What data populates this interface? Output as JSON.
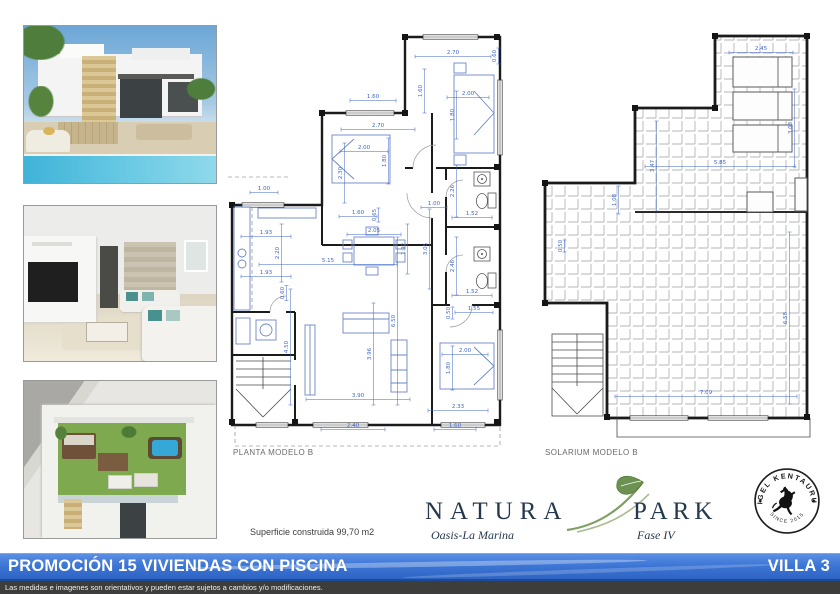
{
  "colors": {
    "bar_blue": "#3d76d6",
    "dimension_blue": "#3f66c8",
    "brand_navy": "#24384e",
    "leaf_green": "#6d9150",
    "pool_blue": "#45b4d8"
  },
  "photos": [
    {
      "name": "villa-exterior-render"
    },
    {
      "name": "living-room-interior-render"
    },
    {
      "name": "rooftop-solarium-render"
    }
  ],
  "plans": {
    "planta": {
      "label": "PLANTA MODELO B",
      "dims": [
        {
          "t": "2.70",
          "x": 225,
          "y": 29,
          "len": 76
        },
        {
          "t": "0.60",
          "x": 268,
          "y": 31,
          "r": -90,
          "len": 16
        },
        {
          "t": "1.60",
          "x": 194,
          "y": 66,
          "r": -90,
          "len": 44
        },
        {
          "t": "2.00",
          "x": 240,
          "y": 70,
          "len": 42
        },
        {
          "t": "1.80",
          "x": 226,
          "y": 90,
          "r": -90,
          "len": 48
        },
        {
          "t": "1.60",
          "x": 145,
          "y": 73,
          "len": 46
        },
        {
          "t": "2.70",
          "x": 150,
          "y": 102,
          "len": 74
        },
        {
          "t": "2.00",
          "x": 136,
          "y": 124,
          "len": 48
        },
        {
          "t": "1.80",
          "x": 158,
          "y": 136,
          "r": -90,
          "len": 46
        },
        {
          "t": "2.30",
          "x": 114,
          "y": 148,
          "r": -90,
          "len": 60
        },
        {
          "t": "1.00",
          "x": 206,
          "y": 180,
          "len": 26
        },
        {
          "t": "1.60",
          "x": 130,
          "y": 189,
          "len": 38
        },
        {
          "t": "0.65",
          "x": 148,
          "y": 190,
          "r": -90,
          "len": 14
        },
        {
          "t": "2.26",
          "x": 226,
          "y": 166,
          "r": -90,
          "len": 52
        },
        {
          "t": "1.52",
          "x": 244,
          "y": 190,
          "len": 40
        },
        {
          "t": "3.05",
          "x": 199,
          "y": 224,
          "r": -90,
          "len": 80
        },
        {
          "t": "2.46",
          "x": 226,
          "y": 241,
          "r": -90,
          "len": 58
        },
        {
          "t": "1.52",
          "x": 244,
          "y": 268,
          "len": 40
        },
        {
          "t": "0.50",
          "x": 222,
          "y": 288,
          "r": -90,
          "len": 12
        },
        {
          "t": "1.55",
          "x": 246,
          "y": 285,
          "len": 38
        },
        {
          "t": "1.00",
          "x": 36,
          "y": 165,
          "len": 28
        },
        {
          "t": "1.93",
          "x": 38,
          "y": 209,
          "len": 50
        },
        {
          "t": "2.20",
          "x": 51,
          "y": 228,
          "r": -90,
          "len": 58
        },
        {
          "t": "1.93",
          "x": 38,
          "y": 249,
          "len": 50
        },
        {
          "t": "0.60",
          "x": 56,
          "y": 268,
          "r": -90,
          "len": 15
        },
        {
          "t": "2.05",
          "x": 146,
          "y": 207,
          "len": 54
        },
        {
          "t": "5.15",
          "x": 100,
          "y": 237,
          "len": 138
        },
        {
          "t": "1.92",
          "x": 177,
          "y": 224,
          "r": -90,
          "len": 50
        },
        {
          "t": "4.50",
          "x": 60,
          "y": 322,
          "r": -90,
          "len": 116
        },
        {
          "t": "3.96",
          "x": 143,
          "y": 329,
          "r": -90,
          "len": 102
        },
        {
          "t": "6.50",
          "x": 167,
          "y": 296,
          "r": -90,
          "len": 168
        },
        {
          "t": "3.90",
          "x": 130,
          "y": 372,
          "len": 104
        },
        {
          "t": "2.40",
          "x": 125,
          "y": 402,
          "len": 64
        },
        {
          "t": "1.60",
          "x": 227,
          "y": 402,
          "len": 42
        },
        {
          "t": "2.33",
          "x": 230,
          "y": 383,
          "len": 60
        },
        {
          "t": "2.00",
          "x": 237,
          "y": 327,
          "len": 46
        },
        {
          "t": "1.80",
          "x": 222,
          "y": 343,
          "r": -90,
          "len": 44
        }
      ]
    },
    "solarium": {
      "label": "SOLARIUM MODELO B",
      "dims": [
        {
          "t": "2.45",
          "x": 221,
          "y": 22,
          "len": 64
        },
        {
          "t": "3.03",
          "x": 252,
          "y": 100,
          "r": -90,
          "len": 78
        },
        {
          "t": "5.85",
          "x": 180,
          "y": 136,
          "len": 150
        },
        {
          "t": "3.47",
          "x": 114,
          "y": 138,
          "r": -90,
          "len": 90
        },
        {
          "t": "1.08",
          "x": 76,
          "y": 172,
          "r": -90,
          "len": 28
        },
        {
          "t": "0.50",
          "x": 22,
          "y": 218,
          "r": -90,
          "len": 12
        },
        {
          "t": "7.09",
          "x": 166,
          "y": 366,
          "len": 182
        },
        {
          "t": "6.58",
          "x": 247,
          "y": 290,
          "r": -90,
          "len": 172
        }
      ]
    }
  },
  "footer": {
    "superficie": "Superficie construida 99,70 m2",
    "brand": {
      "word1": "NATURA",
      "word2": "PARK",
      "sub1": "Oasis-La Marina",
      "sub2": "Fase IV"
    },
    "stamp": {
      "arc_top": "RIGEL KENTAURUS",
      "arc_bottom": "SINCE 2015"
    },
    "title_bar": {
      "left": "PROMOCIÓN 15 VIVIENDAS CON PISCINA",
      "right": "VILLA 3"
    },
    "disclaimer": "Las medidas e imagenes son orientativos y pueden estar sujetos a cambios y/o modificaciones."
  }
}
